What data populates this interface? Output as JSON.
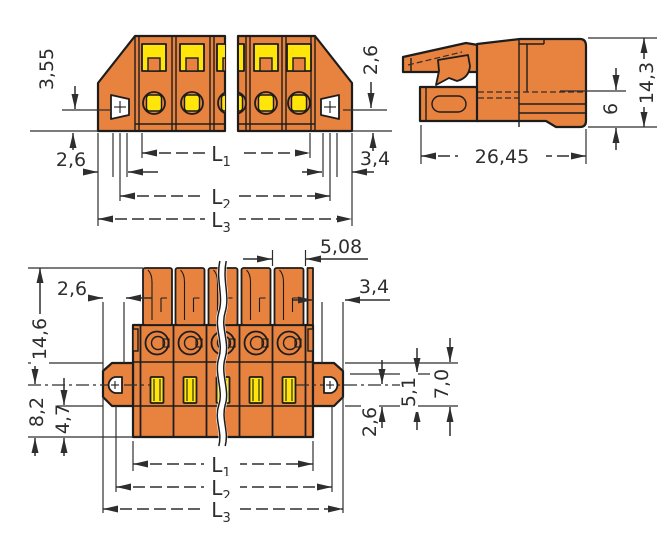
{
  "colors": {
    "body_orange": "#E8823F",
    "clamp_yellow": "#FFE50A",
    "outline": "#1d1d1d",
    "dimension": "#2e2e2e",
    "background": "#ffffff"
  },
  "views": {
    "top_front": {
      "dim_flange_top_to_hole": "3,55",
      "dim_hole_to_bottom": "2,6",
      "dim_right_hole_to_bottom": "2,6",
      "dim_flange_width": "3,4",
      "len1": {
        "base": "L",
        "sub": "1"
      },
      "len2": {
        "base": "L",
        "sub": "2"
      },
      "len3": {
        "base": "L",
        "sub": "3"
      }
    },
    "side": {
      "dim_total_height": "14,3",
      "dim_lower_height": "6",
      "dim_total_depth": "26,45"
    },
    "bottom_front": {
      "dim_pitch": "5,08",
      "dim_edge_to_hole": "2,6",
      "dim_flange_width": "3,4",
      "dim_upper_height": "14,6",
      "dim_lower_height": "8,2",
      "dim_foot_height": "4,7",
      "dim_hole_to_flange_bottom": "2,6",
      "dim_slot_height": "5,1",
      "dim_flange_height": "7,0",
      "len1": {
        "base": "L",
        "sub": "1"
      },
      "len2": {
        "base": "L",
        "sub": "2"
      },
      "len3": {
        "base": "L",
        "sub": "3"
      }
    }
  }
}
